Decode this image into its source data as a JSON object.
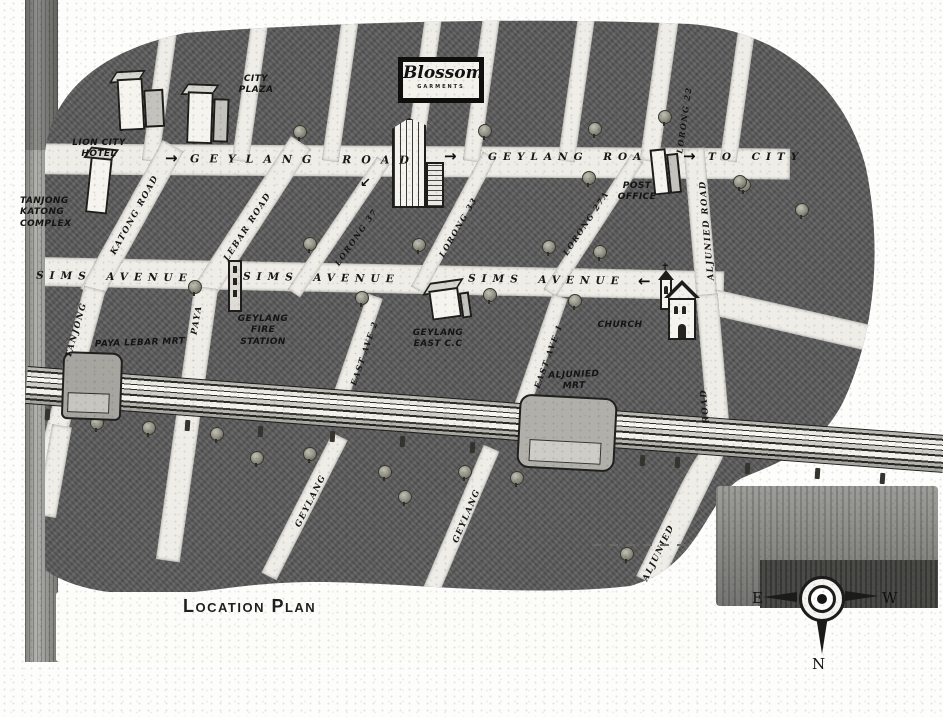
{
  "map": {
    "caption": "Location Plan",
    "sign": {
      "name": "Blossom",
      "sub": "GARMENTS"
    },
    "roads": {
      "geylang_left": {
        "label": "GEYLANG ROAD"
      },
      "geylang_mid": {
        "label": "GEYLANG ROA"
      },
      "to_city": {
        "label": "TO CITY"
      },
      "sims_left": {
        "label": "SIMS AVENUE"
      },
      "sims_mid": {
        "label": "SIMS AVENUE"
      },
      "sims_right": {
        "label": "SIMS AVENUE"
      },
      "katong": {
        "label": "KATONG ROAD"
      },
      "tanjong": {
        "label": "TANJONG"
      },
      "paya": {
        "label": "PAYA"
      },
      "lebar": {
        "label": "LEBAR ROAD"
      },
      "lorong37": {
        "label": "LORONG 37"
      },
      "lorong33": {
        "label": "LORONG 33"
      },
      "lorong27a": {
        "label": "LORONG 27A"
      },
      "lorong22": {
        "label": "LORONG 22"
      },
      "aljunied_upper": {
        "label": "ALJUNIED ROAD"
      },
      "aljunied_seg": {
        "label": "ROAD"
      },
      "aljunied_lower": {
        "label": "ALJUNIED"
      },
      "east_ave_2": {
        "label": "EAST AVE 2"
      },
      "east_ave_1": {
        "label": "EAST AVE 1"
      },
      "geylang_lorong_west": {
        "label": "GEYLANG"
      },
      "geylang_lorong_east": {
        "label": "GEYLANG"
      }
    },
    "landmarks": {
      "lion_city_hotel": {
        "lines": [
          "LION CITY",
          "HOTEL"
        ]
      },
      "city_plaza": {
        "lines": [
          "CITY",
          "PLAZA"
        ]
      },
      "tanjong_katong_complex": {
        "lines": [
          "TANJONG",
          "KATONG",
          "COMPLEX"
        ]
      },
      "post_office": {
        "lines": [
          "POST",
          "OFFICE"
        ]
      },
      "geylang_fire_station": {
        "lines": [
          "GEYLANG",
          "FIRE",
          "STATION"
        ]
      },
      "geylang_east_cc": {
        "lines": [
          "GEYLANG",
          "EAST C.C"
        ]
      },
      "church": {
        "label": "CHURCH"
      },
      "paya_lebar_mrt": {
        "label": "PAYA LEBAR MRT"
      },
      "aljunied_mrt": {
        "lines": [
          "ALJUNIED",
          "MRT"
        ]
      }
    },
    "arrows": {
      "right": "→",
      "left": "←",
      "turn_left": "↙"
    },
    "compass": {
      "east": "E",
      "west": "W",
      "north": "N"
    }
  },
  "colors": {
    "map_gray": "#5c5c5d",
    "road_white": "#efede7",
    "ink_black": "#1a1a1a",
    "page_white": "#fdfdfc"
  }
}
